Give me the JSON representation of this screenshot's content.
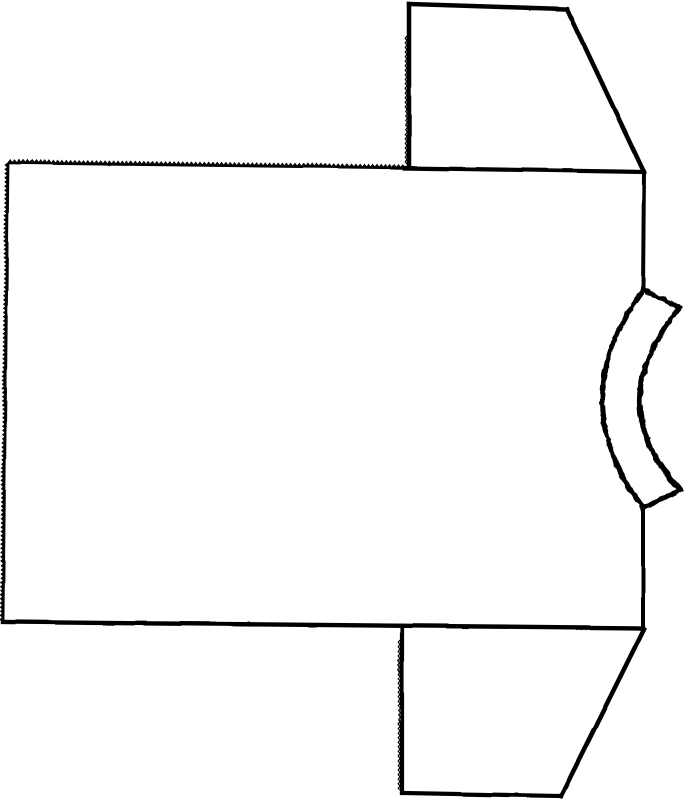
{
  "page": {
    "background_color": "#ffffff",
    "ink_color": "#000000"
  },
  "figure": {
    "canvas": {
      "width": 687,
      "height": 800
    },
    "pieces": [
      {
        "name": "body-panel",
        "rough": false,
        "strokes": [
          {
            "name": "body-top-edge-serrated",
            "kind": "zigzag",
            "from": [
              8,
              163
            ],
            "to": [
              405,
              168
            ],
            "period": 4.3,
            "amp": 2.8,
            "normal": [
              0,
              -1
            ],
            "base_width": 2.6,
            "tooth_width": 1.4
          },
          {
            "name": "body-top-edge",
            "kind": "line",
            "from": [
              405,
              168
            ],
            "to": [
              644,
              172
            ],
            "width": 4.2
          },
          {
            "name": "body-right-edge-upper",
            "kind": "line",
            "from": [
              644,
              172
            ],
            "to": [
              643,
              290
            ],
            "width": 4.0
          },
          {
            "name": "body-right-edge-lower",
            "kind": "line",
            "from": [
              643,
              508
            ],
            "to": [
              643,
              628
            ],
            "width": 4.0
          },
          {
            "name": "body-bottom-edge",
            "kind": "line",
            "from": [
              643,
              628
            ],
            "to": [
              3,
              622
            ],
            "width": 4.4
          },
          {
            "name": "body-left-edge-serrated",
            "kind": "zigzag",
            "from": [
              3,
              622
            ],
            "to": [
              8,
              163
            ],
            "period": 4.2,
            "amp": 2.5,
            "normal": [
              -1,
              0
            ],
            "base_width": 2.8,
            "tooth_width": 1.4
          }
        ]
      },
      {
        "name": "top-sleeve",
        "rough": false,
        "strokes": [
          {
            "name": "top-sleeve-left-edge",
            "kind": "line",
            "from": [
              409,
              167
            ],
            "to": [
              409,
              4
            ],
            "width": 4.5
          },
          {
            "name": "top-sleeve-left-notches",
            "kind": "zigzag",
            "from": [
              407,
              36
            ],
            "to": [
              407,
              164
            ],
            "period": 4.6,
            "amp": 1.8,
            "normal": [
              -1,
              0
            ],
            "base_width": 0,
            "tooth_width": 1.2
          },
          {
            "name": "top-sleeve-top-edge",
            "kind": "line",
            "from": [
              409,
              4
            ],
            "to": [
              567,
              9
            ],
            "width": 4.5
          },
          {
            "name": "top-sleeve-underarm-edge",
            "kind": "line",
            "from": [
              567,
              9
            ],
            "to": [
              644,
              172
            ],
            "width": 4.5
          }
        ]
      },
      {
        "name": "bottom-sleeve",
        "rough": false,
        "strokes": [
          {
            "name": "bottom-sleeve-left-edge",
            "kind": "line",
            "from": [
              402,
              626
            ],
            "to": [
              402,
              793
            ],
            "width": 4.2
          },
          {
            "name": "bottom-sleeve-left-notches",
            "kind": "zigzag",
            "from": [
              400,
              640
            ],
            "to": [
              400,
              790
            ],
            "period": 4.6,
            "amp": 1.8,
            "normal": [
              -1,
              0
            ],
            "base_width": 0,
            "tooth_width": 1.2
          },
          {
            "name": "bottom-sleeve-bottom-edge",
            "kind": "line",
            "from": [
              402,
              793
            ],
            "to": [
              561,
              796
            ],
            "width": 4.2
          },
          {
            "name": "bottom-sleeve-underarm-edge",
            "kind": "line",
            "from": [
              561,
              796
            ],
            "to": [
              644,
              629
            ],
            "width": 4.5
          }
        ]
      },
      {
        "name": "neckband",
        "rough": true,
        "strokes": [
          {
            "name": "neckband-inner-curve",
            "kind": "path",
            "d": "M 643,290 Q 562,399 643,508",
            "width": 5
          },
          {
            "name": "neckband-outer-curve",
            "kind": "path",
            "d": "M 680,307 Q 600,404 680,490",
            "width": 5
          },
          {
            "name": "neckband-top-end",
            "kind": "line",
            "from": [
              643,
              290
            ],
            "to": [
              680,
              307
            ],
            "width": 5
          },
          {
            "name": "neckband-bottom-end",
            "kind": "line",
            "from": [
              643,
              508
            ],
            "to": [
              680,
              490
            ],
            "width": 5
          }
        ]
      }
    ]
  }
}
